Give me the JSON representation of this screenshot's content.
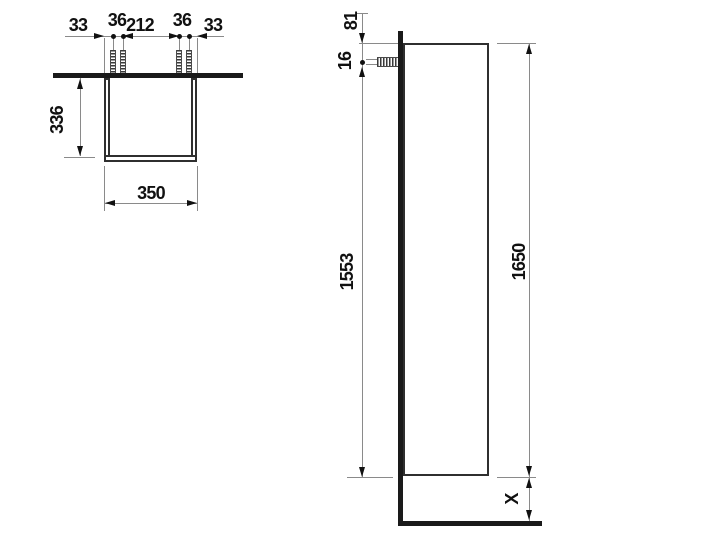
{
  "drawing_type": "furniture dimensional drawing (tall cabinet, top view and side view)",
  "colors": {
    "background": "#ffffff",
    "ink": "#111111",
    "thin_line": "#8a8a8a",
    "wall_floor_bar": "#1a1a1a",
    "outline": "#2f2f2f"
  },
  "top_view": {
    "chain": [
      "33",
      "36",
      "212",
      "36",
      "33"
    ],
    "depth": "336",
    "width": "350"
  },
  "side_view": {
    "top_gap": "81",
    "screw_inset": "16",
    "fixing_span": "1553",
    "total_height": "1650",
    "base_clearance": "X"
  }
}
